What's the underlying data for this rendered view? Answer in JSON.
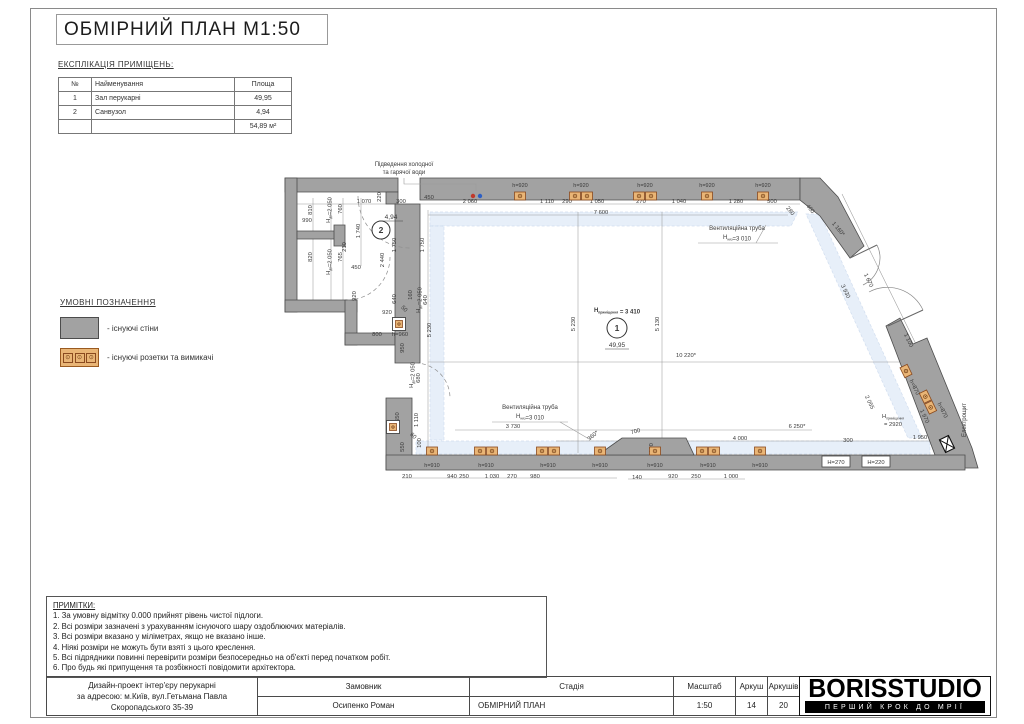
{
  "sheet_title": "ОБМІРНИЙ ПЛАН М1:50",
  "explication": {
    "heading": "ЕКСПЛІКАЦІЯ ПРИМІЩЕНЬ:",
    "columns": [
      "№",
      "Найменування",
      "Площа"
    ],
    "rows": [
      [
        "1",
        "Зал перукарні",
        "49,95"
      ],
      [
        "2",
        "Санвузол",
        "4,94"
      ]
    ],
    "total": "54,89 м²"
  },
  "legend": {
    "heading": "УМОВНІ ПОЗНАЧЕННЯ",
    "wall_label": "- існуючі стіни",
    "socket_label": "- існуючі розетки та вимикачі"
  },
  "notes": {
    "heading": "ПРИМІТКИ:",
    "lines": [
      "1. За умовну відмітку 0.000 прийнят рівень чистої підлоги.",
      "2. Всі розміри зазначені з урахуванням існуючого шару оздоблюючих матеріалів.",
      "3. Всі розміри вказано у міліметрах, якщо не вказано інше.",
      "4. Ніякі розміри не можуть бути взяті з цього креслення.",
      "5. Всі підрядники повинні перевірити розміри безпосередньо на об'єкті перед початком робіт.",
      "6. Про будь які припущення та розбіжності повідомити архітектора."
    ]
  },
  "titleblock": {
    "project": [
      "Дизайн-проект інтер'єру перукарні",
      "за адресою: м.Київ, вул.Гетьмана Павла",
      "Скоропадського 35-39"
    ],
    "customer_label": "Замовник",
    "customer": "Осипенко Роман",
    "stage_label": "Стадія",
    "stage": "ОБМІРНИЙ ПЛАН",
    "scale_label": "Масштаб",
    "scale": "1:50",
    "sheet_label": "Аркуш",
    "sheet": "14",
    "sheets_label": "Аркушів",
    "sheets": "20",
    "logo": "BORISSTUDIO",
    "logo_tagline": "ПЕРШИЙ КРОК ДО МРІЇ"
  },
  "plan": {
    "colors": {
      "wall": "#a2a2a2",
      "wall_stroke": "#4c4c4c",
      "socket_fill": "#e9b576",
      "socket_stroke": "#8a4a1f",
      "band": "#dfe9f7",
      "band_stroke": "#c0d2ea",
      "dim_text": "#3a3a3a",
      "line": "#9b9b9b",
      "water_hot": "#c0392b",
      "water_cold": "#2d5fc4"
    },
    "rooms": [
      {
        "num": "1",
        "area": "49,95",
        "cx": 617,
        "cy": 328,
        "r": 10,
        "height_label": "H[приміщення] = 3 410",
        "hx": 617,
        "hy": 312,
        "ax": 617,
        "ay": 347
      },
      {
        "num": "2",
        "area": "4,94",
        "cx": 381,
        "cy": 230,
        "r": 9,
        "ax": 391,
        "ay": 219
      }
    ],
    "annotations": [
      {
        "t": "Підведення холодної",
        "x": 404,
        "y": 166
      },
      {
        "t": "та гарячої води",
        "x": 404,
        "y": 174
      },
      {
        "t": "Вентиляційна труба",
        "x": 737,
        "y": 230
      },
      {
        "t": "H[низ]=3 010",
        "x": 737,
        "y": 239
      },
      {
        "t": "Вентиляційна труба",
        "x": 530,
        "y": 409
      },
      {
        "t": "H[низ]=3 010",
        "x": 530,
        "y": 418
      },
      {
        "t": "Електрощит",
        "x": 966,
        "y": 420,
        "r": -90
      }
    ],
    "dimensions": [
      {
        "t": "450",
        "x": 429,
        "y": 199
      },
      {
        "t": "2 060",
        "x": 470,
        "y": 203
      },
      {
        "t": "1 110",
        "x": 547,
        "y": 203
      },
      {
        "t": "290",
        "x": 567,
        "y": 203
      },
      {
        "t": "1 050",
        "x": 597,
        "y": 203
      },
      {
        "t": "270",
        "x": 641,
        "y": 203
      },
      {
        "t": "1 040",
        "x": 679,
        "y": 203
      },
      {
        "t": "1 280",
        "x": 736,
        "y": 203
      },
      {
        "t": "500",
        "x": 772,
        "y": 203
      },
      {
        "t": "280",
        "x": 789,
        "y": 212,
        "r": 50
      },
      {
        "t": "7 600",
        "x": 601,
        "y": 214
      },
      {
        "t": "810",
        "x": 312,
        "y": 210,
        "r": -90
      },
      {
        "t": "990",
        "x": 307,
        "y": 222
      },
      {
        "t": "820",
        "x": 312,
        "y": 257,
        "r": -90
      },
      {
        "t": "H[дв]=2 050",
        "x": 330,
        "y": 210,
        "r": -90
      },
      {
        "t": "H[дв]=2 050",
        "x": 330,
        "y": 262,
        "r": -90
      },
      {
        "t": "760",
        "x": 342,
        "y": 209,
        "r": -90
      },
      {
        "t": "210",
        "x": 346,
        "y": 247,
        "r": -90
      },
      {
        "t": "765",
        "x": 342,
        "y": 257,
        "r": -90
      },
      {
        "t": "450",
        "x": 356,
        "y": 269
      },
      {
        "t": "1 070",
        "x": 364,
        "y": 203
      },
      {
        "t": "220",
        "x": 381,
        "y": 197,
        "r": -90
      },
      {
        "t": "300",
        "x": 401,
        "y": 203
      },
      {
        "t": "1 740",
        "x": 360,
        "y": 231,
        "r": -90
      },
      {
        "t": "2 440",
        "x": 384,
        "y": 260,
        "r": -90
      },
      {
        "t": "1 750",
        "x": 396,
        "y": 245,
        "r": -90
      },
      {
        "t": "1 750",
        "x": 424,
        "y": 245,
        "r": -90
      },
      {
        "t": "920",
        "x": 356,
        "y": 296,
        "r": -90
      },
      {
        "t": "920",
        "x": 387,
        "y": 314
      },
      {
        "t": "640",
        "x": 396,
        "y": 299,
        "r": -90
      },
      {
        "t": "160",
        "x": 412,
        "y": 295,
        "r": -90
      },
      {
        "t": "50",
        "x": 403,
        "y": 310,
        "r": 45
      },
      {
        "t": "H[дв]=2 050",
        "x": 420,
        "y": 300,
        "r": -90
      },
      {
        "t": "640",
        "x": 427,
        "y": 300,
        "r": -90
      },
      {
        "t": "800",
        "x": 377,
        "y": 336
      },
      {
        "t": "h=960",
        "x": 400,
        "y": 336
      },
      {
        "t": "5 230",
        "x": 431,
        "y": 330,
        "r": -90
      },
      {
        "t": "950",
        "x": 404,
        "y": 348,
        "r": -90
      },
      {
        "t": "680",
        "x": 420,
        "y": 378,
        "r": -90
      },
      {
        "t": "H[дв]=2 050",
        "x": 413,
        "y": 375,
        "r": -90
      },
      {
        "t": "1 110",
        "x": 418,
        "y": 420,
        "r": -90
      },
      {
        "t": "h=1550",
        "x": 399,
        "y": 422,
        "r": -90
      },
      {
        "t": "60",
        "x": 412,
        "y": 437,
        "r": 45
      },
      {
        "t": "100",
        "x": 421,
        "y": 443,
        "r": -90
      },
      {
        "t": "550",
        "x": 404,
        "y": 447,
        "r": -90
      },
      {
        "t": "5 230",
        "x": 575,
        "y": 324,
        "r": -90
      },
      {
        "t": "5 130",
        "x": 659,
        "y": 324,
        "r": -90
      },
      {
        "t": "10 220*",
        "x": 686,
        "y": 357
      },
      {
        "t": "3 730",
        "x": 513,
        "y": 428
      },
      {
        "t": "360*",
        "x": 594,
        "y": 437,
        "r": -40
      },
      {
        "t": "700",
        "x": 636,
        "y": 433,
        "r": -15
      },
      {
        "t": "100",
        "x": 653,
        "y": 448,
        "r": -90
      },
      {
        "t": "210",
        "x": 407,
        "y": 478
      },
      {
        "t": "940",
        "x": 452,
        "y": 478
      },
      {
        "t": "250",
        "x": 464,
        "y": 478
      },
      {
        "t": "1 030",
        "x": 492,
        "y": 478
      },
      {
        "t": "270",
        "x": 512,
        "y": 478
      },
      {
        "t": "980",
        "x": 535,
        "y": 478
      },
      {
        "t": "140",
        "x": 637,
        "y": 479
      },
      {
        "t": "920",
        "x": 673,
        "y": 478
      },
      {
        "t": "250",
        "x": 696,
        "y": 478
      },
      {
        "t": "1 000",
        "x": 731,
        "y": 478
      },
      {
        "t": "400",
        "x": 809,
        "y": 210,
        "r": 50
      },
      {
        "t": "1 160*",
        "x": 837,
        "y": 230,
        "r": 50
      },
      {
        "t": "1 670",
        "x": 867,
        "y": 281,
        "r": 64
      },
      {
        "t": "3 930",
        "x": 844,
        "y": 292,
        "r": 64
      },
      {
        "t": "1 100",
        "x": 907,
        "y": 341,
        "r": 64
      },
      {
        "t": "2 055",
        "x": 868,
        "y": 403,
        "r": 64
      },
      {
        "t": "1 970",
        "x": 923,
        "y": 417,
        "r": 64
      },
      {
        "t": "h=870",
        "x": 913,
        "y": 388,
        "r": 64
      },
      {
        "t": "h=870",
        "x": 941,
        "y": 411,
        "r": 64
      },
      {
        "t": "H[приміщення]",
        "x": 893,
        "y": 418
      },
      {
        "t": "= 2920",
        "x": 893,
        "y": 426
      },
      {
        "t": "6 250*",
        "x": 797,
        "y": 428
      },
      {
        "t": "4 000",
        "x": 740,
        "y": 440
      },
      {
        "t": "300",
        "x": 848,
        "y": 442
      },
      {
        "t": "1 950",
        "x": 920,
        "y": 439
      }
    ],
    "height_boxes": [
      {
        "t": "H=270",
        "x": 836,
        "y": 464,
        "bx": 822,
        "by": 456,
        "w": 28,
        "h": 11
      },
      {
        "t": "H=220",
        "x": 876,
        "y": 464,
        "bx": 862,
        "by": 456,
        "w": 28,
        "h": 11
      }
    ],
    "socket_groups": [
      {
        "x": 520,
        "y": 196,
        "n": 1,
        "label": "h=920",
        "ly": 187
      },
      {
        "x": 581,
        "y": 196,
        "n": 2,
        "label": "h=920",
        "ly": 187
      },
      {
        "x": 645,
        "y": 196,
        "n": 2,
        "label": "h=920",
        "ly": 187
      },
      {
        "x": 707,
        "y": 196,
        "n": 1,
        "label": "h=920",
        "ly": 187
      },
      {
        "x": 763,
        "y": 196,
        "n": 1,
        "label": "h=920",
        "ly": 187
      },
      {
        "x": 432,
        "y": 451,
        "n": 1,
        "label": "h=910",
        "ly": 467
      },
      {
        "x": 486,
        "y": 451,
        "n": 2,
        "label": "h=910",
        "ly": 467
      },
      {
        "x": 548,
        "y": 451,
        "n": 2,
        "label": "h=910",
        "ly": 467
      },
      {
        "x": 600,
        "y": 451,
        "n": 1,
        "label": "h=910",
        "ly": 467
      },
      {
        "x": 655,
        "y": 451,
        "n": 1,
        "label": "h=910",
        "ly": 467
      },
      {
        "x": 708,
        "y": 451,
        "n": 2,
        "label": "h=910",
        "ly": 467
      },
      {
        "x": 760,
        "y": 451,
        "n": 1,
        "label": "h=910",
        "ly": 467
      },
      {
        "x": 906,
        "y": 371,
        "n": 1,
        "r": 64
      },
      {
        "x": 928,
        "y": 402,
        "n": 2,
        "r": 64
      }
    ],
    "boxed_sockets": [
      {
        "x": 399,
        "y": 324
      },
      {
        "x": 393,
        "y": 427
      }
    ]
  }
}
